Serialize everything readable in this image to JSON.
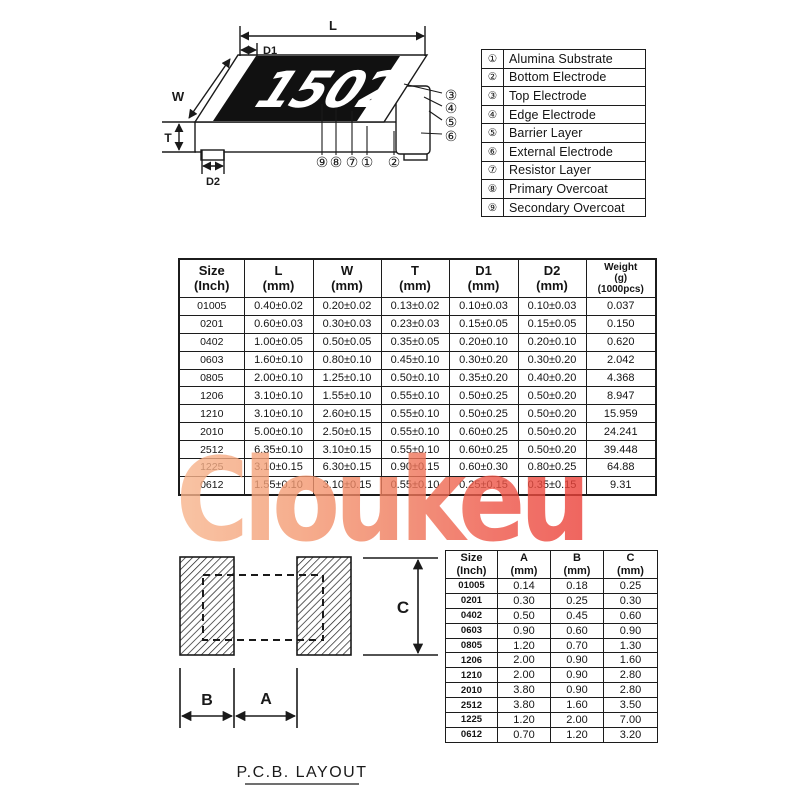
{
  "watermark": {
    "text": "Cloukeu",
    "color_start": "#f8b68e",
    "color_end": "#ec4038"
  },
  "resistor_diagram": {
    "marking": "1502",
    "dims": {
      "L": "L",
      "D1": "D1",
      "W": "W",
      "T": "T",
      "D2": "D2"
    },
    "callouts": {
      "c1": "①",
      "c2": "②",
      "c3": "③",
      "c4": "④",
      "c5": "⑤",
      "c6": "⑥",
      "c7": "⑦",
      "c8": "⑧",
      "c9": "⑨"
    }
  },
  "legend": {
    "rows": [
      [
        "①",
        "Alumina Substrate"
      ],
      [
        "②",
        "Bottom Electrode"
      ],
      [
        "③",
        "Top Electrode"
      ],
      [
        "④",
        "Edge Electrode"
      ],
      [
        "⑤",
        "Barrier Layer"
      ],
      [
        "⑥",
        "External Electrode"
      ],
      [
        "⑦",
        "Resistor Layer"
      ],
      [
        "⑧",
        "Primary Overcoat"
      ],
      [
        "⑨",
        "Secondary Overcoat"
      ]
    ]
  },
  "dim_table": {
    "headers": [
      {
        "l1": "Size",
        "l2": "(Inch)"
      },
      {
        "l1": "L",
        "l2": "(mm)"
      },
      {
        "l1": "W",
        "l2": "(mm)"
      },
      {
        "l1": "T",
        "l2": "(mm)"
      },
      {
        "l1": "D1",
        "l2": "(mm)"
      },
      {
        "l1": "D2",
        "l2": "(mm)"
      },
      {
        "l1": "Weight",
        "l2": "(g)",
        "l3": "(1000pcs)"
      }
    ],
    "rows": [
      [
        "01005",
        "0.40±0.02",
        "0.20±0.02",
        "0.13±0.02",
        "0.10±0.03",
        "0.10±0.03",
        "0.037"
      ],
      [
        "0201",
        "0.60±0.03",
        "0.30±0.03",
        "0.23±0.03",
        "0.15±0.05",
        "0.15±0.05",
        "0.150"
      ],
      [
        "0402",
        "1.00±0.05",
        "0.50±0.05",
        "0.35±0.05",
        "0.20±0.10",
        "0.20±0.10",
        "0.620"
      ],
      [
        "0603",
        "1.60±0.10",
        "0.80±0.10",
        "0.45±0.10",
        "0.30±0.20",
        "0.30±0.20",
        "2.042"
      ],
      [
        "0805",
        "2.00±0.10",
        "1.25±0.10",
        "0.50±0.10",
        "0.35±0.20",
        "0.40±0.20",
        "4.368"
      ],
      [
        "1206",
        "3.10±0.10",
        "1.55±0.10",
        "0.55±0.10",
        "0.50±0.25",
        "0.50±0.20",
        "8.947"
      ],
      [
        "1210",
        "3.10±0.10",
        "2.60±0.15",
        "0.55±0.10",
        "0.50±0.25",
        "0.50±0.20",
        "15.959"
      ],
      [
        "2010",
        "5.00±0.10",
        "2.50±0.15",
        "0.55±0.10",
        "0.60±0.25",
        "0.50±0.20",
        "24.241"
      ],
      [
        "2512",
        "6.35±0.10",
        "3.10±0.15",
        "0.55±0.10",
        "0.60±0.25",
        "0.50±0.20",
        "39.448"
      ],
      [
        "1225",
        "3.10±0.15",
        "6.30±0.15",
        "0.90±0.15",
        "0.60±0.30",
        "0.80±0.25",
        "64.88"
      ],
      [
        "0612",
        "1.55±0.10",
        "3.10±0.15",
        "0.55±0.10",
        "0.25±0.15",
        "0.35±0.15",
        "9.31"
      ]
    ]
  },
  "pcb": {
    "dims": {
      "A": "A",
      "B": "B",
      "C": "C"
    },
    "caption": "P.C.B. LAYOUT"
  },
  "pad_table": {
    "headers": [
      {
        "l1": "Size",
        "l2": "(Inch)"
      },
      {
        "l1": "A",
        "l2": "(mm)"
      },
      {
        "l1": "B",
        "l2": "(mm)"
      },
      {
        "l1": "C",
        "l2": "(mm)"
      }
    ],
    "rows": [
      [
        "01005",
        "0.14",
        "0.18",
        "0.25"
      ],
      [
        "0201",
        "0.30",
        "0.25",
        "0.30"
      ],
      [
        "0402",
        "0.50",
        "0.45",
        "0.60"
      ],
      [
        "0603",
        "0.90",
        "0.60",
        "0.90"
      ],
      [
        "0805",
        "1.20",
        "0.70",
        "1.30"
      ],
      [
        "1206",
        "2.00",
        "0.90",
        "1.60"
      ],
      [
        "1210",
        "2.00",
        "0.90",
        "2.80"
      ],
      [
        "2010",
        "3.80",
        "0.90",
        "2.80"
      ],
      [
        "2512",
        "3.80",
        "1.60",
        "3.50"
      ],
      [
        "1225",
        "1.20",
        "2.00",
        "7.00"
      ],
      [
        "0612",
        "0.70",
        "1.20",
        "3.20"
      ]
    ]
  }
}
